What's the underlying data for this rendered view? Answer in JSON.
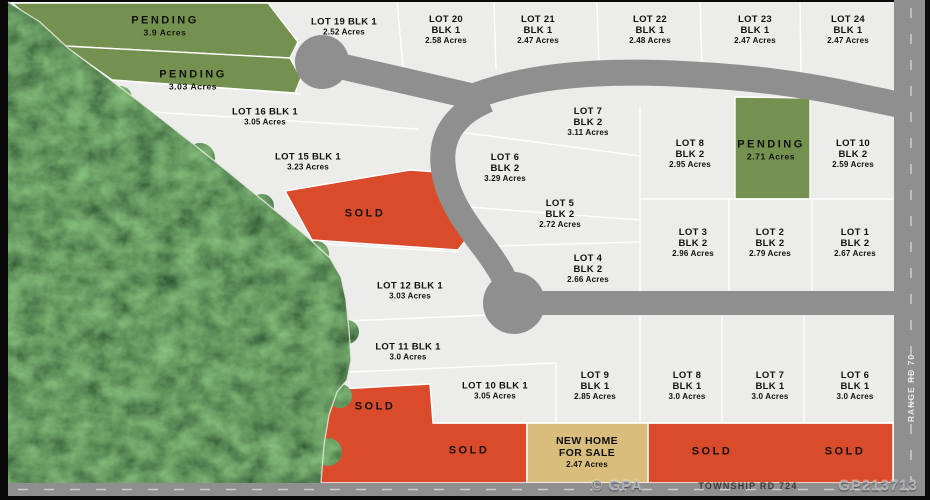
{
  "map": {
    "colors": {
      "sold": "#D94B2B",
      "pending": "#75914F",
      "sale": "#D8BD7C",
      "road": "#8F8F8F",
      "lot": "#ECECEA",
      "line": "#FFFFFF",
      "forest": "#16230D",
      "dash": "#D8D8D8"
    },
    "range_road_label": "RANGE RD 70",
    "township_road_label": "TOWNSHIP RD 724",
    "watermark_left": "© GPA",
    "watermark_right": "GP213713",
    "labels": [
      {
        "kind": "status",
        "lines": [
          "PENDING",
          "3.9 Acres"
        ],
        "x": 165,
        "y": 26
      },
      {
        "kind": "status",
        "lines": [
          "PENDING",
          "3.03 Acres"
        ],
        "x": 193,
        "y": 80
      },
      {
        "kind": "lot",
        "lines": [
          "LOT 19 BLK 1",
          "2.52 Acres"
        ],
        "x": 344,
        "y": 27
      },
      {
        "kind": "lot",
        "lines": [
          "LOT 20",
          "BLK 1",
          "2.58 Acres"
        ],
        "x": 446,
        "y": 30
      },
      {
        "kind": "lot",
        "lines": [
          "LOT 21",
          "BLK 1",
          "2.47 Acres"
        ],
        "x": 538,
        "y": 30
      },
      {
        "kind": "lot",
        "lines": [
          "LOT 22",
          "BLK 1",
          "2.48 Acres"
        ],
        "x": 650,
        "y": 30
      },
      {
        "kind": "lot",
        "lines": [
          "LOT 23",
          "BLK 1",
          "2.47 Acres"
        ],
        "x": 755,
        "y": 30
      },
      {
        "kind": "lot",
        "lines": [
          "LOT 24",
          "BLK 1",
          "2.47 Acres"
        ],
        "x": 848,
        "y": 30
      },
      {
        "kind": "lot",
        "lines": [
          "LOT 16 BLK 1",
          "3.05 Acres"
        ],
        "x": 265,
        "y": 117
      },
      {
        "kind": "lot",
        "lines": [
          "LOT 15 BLK 1",
          "3.23 Acres"
        ],
        "x": 308,
        "y": 162
      },
      {
        "kind": "status",
        "lines": [
          "SOLD"
        ],
        "x": 365,
        "y": 214
      },
      {
        "kind": "lot",
        "lines": [
          "LOT 7",
          "BLK 2",
          "3.11 Acres"
        ],
        "x": 588,
        "y": 122
      },
      {
        "kind": "lot",
        "lines": [
          "LOT 6",
          "BLK 2",
          "3.29 Acres"
        ],
        "x": 505,
        "y": 168
      },
      {
        "kind": "lot",
        "lines": [
          "LOT 8",
          "BLK 2",
          "2.95 Acres"
        ],
        "x": 690,
        "y": 154
      },
      {
        "kind": "status",
        "lines": [
          "PENDING",
          "2.71 Acres"
        ],
        "x": 771,
        "y": 150
      },
      {
        "kind": "lot",
        "lines": [
          "LOT 10",
          "BLK 2",
          "2.59 Acres"
        ],
        "x": 853,
        "y": 154
      },
      {
        "kind": "lot",
        "lines": [
          "LOT 5",
          "BLK 2",
          "2.72 Acres"
        ],
        "x": 560,
        "y": 214
      },
      {
        "kind": "lot",
        "lines": [
          "LOT 3",
          "BLK 2",
          "2.96 Acres"
        ],
        "x": 693,
        "y": 243
      },
      {
        "kind": "lot",
        "lines": [
          "LOT 2",
          "BLK 2",
          "2.79 Acres"
        ],
        "x": 770,
        "y": 243
      },
      {
        "kind": "lot",
        "lines": [
          "LOT 1",
          "BLK 2",
          "2.67 Acres"
        ],
        "x": 855,
        "y": 243
      },
      {
        "kind": "lot",
        "lines": [
          "LOT 4",
          "BLK 2",
          "2.66 Acres"
        ],
        "x": 588,
        "y": 269
      },
      {
        "kind": "lot",
        "lines": [
          "LOT 12 BLK 1",
          "3.03 Acres"
        ],
        "x": 410,
        "y": 291
      },
      {
        "kind": "lot",
        "lines": [
          "LOT 11 BLK 1",
          "3.0 Acres"
        ],
        "x": 408,
        "y": 352
      },
      {
        "kind": "lot",
        "lines": [
          "LOT 10 BLK 1",
          "3.05 Acres"
        ],
        "x": 495,
        "y": 391
      },
      {
        "kind": "lot",
        "lines": [
          "LOT 9",
          "BLK 1",
          "2.85 Acres"
        ],
        "x": 595,
        "y": 386
      },
      {
        "kind": "lot",
        "lines": [
          "LOT 8",
          "BLK 1",
          "3.0 Acres"
        ],
        "x": 687,
        "y": 386
      },
      {
        "kind": "lot",
        "lines": [
          "LOT 7",
          "BLK 1",
          "3.0 Acres"
        ],
        "x": 770,
        "y": 386
      },
      {
        "kind": "lot",
        "lines": [
          "LOT 6",
          "BLK 1",
          "3.0 Acres"
        ],
        "x": 855,
        "y": 386
      },
      {
        "kind": "status",
        "lines": [
          "SOLD"
        ],
        "x": 375,
        "y": 407
      },
      {
        "kind": "status",
        "lines": [
          "SOLD"
        ],
        "x": 469,
        "y": 451
      },
      {
        "kind": "sale",
        "lines": [
          "NEW HOME",
          "FOR SALE",
          "2.47 Acres"
        ],
        "x": 587,
        "y": 452
      },
      {
        "kind": "status",
        "lines": [
          "SOLD"
        ],
        "x": 712,
        "y": 452
      },
      {
        "kind": "status",
        "lines": [
          "SOLD"
        ],
        "x": 845,
        "y": 452
      }
    ]
  }
}
